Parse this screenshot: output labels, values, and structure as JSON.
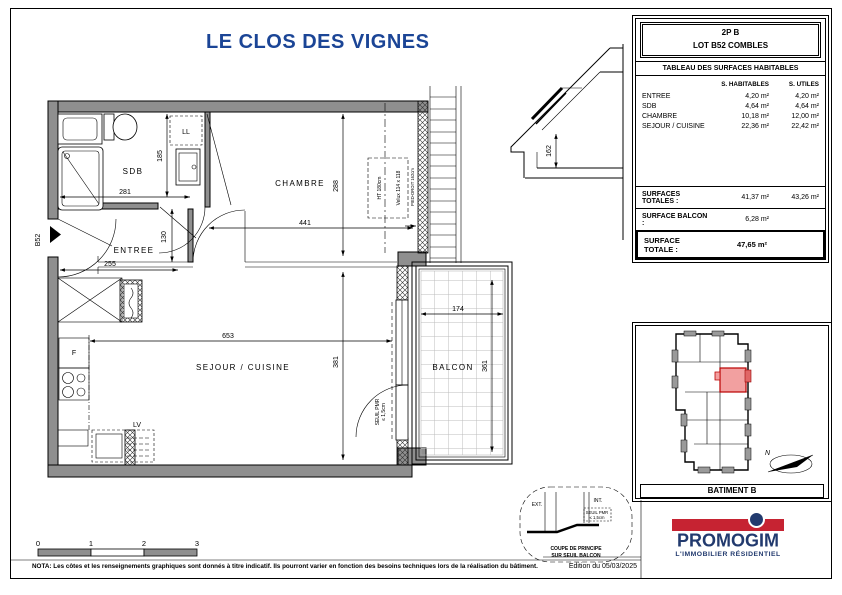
{
  "title": "LE CLOS DES VIGNES",
  "colors": {
    "title_blue": "#1b4596",
    "promogim_blue": "#223a6e",
    "promogim_red": "#c62332",
    "wall_gray": "#8f8f8f",
    "highlight_pink": "#f2a0a0",
    "highlight_red": "#bb0000"
  },
  "surface_table": {
    "unit": "2P B",
    "lot": "LOT B52 COMBLES",
    "table_title": "TABLEAU DES SURFACES HABITABLES",
    "col_habitables": "S. HABITABLES",
    "col_utiles": "S. UTILES",
    "rows": [
      {
        "name": "ENTREE",
        "habitable": "4,20 m²",
        "utile": "4,20 m²"
      },
      {
        "name": "SDB",
        "habitable": "4,64 m²",
        "utile": "4,64 m²"
      },
      {
        "name": "CHAMBRE",
        "habitable": "10,18 m²",
        "utile": "12,00 m²"
      },
      {
        "name": "SEJOUR / CUISINE",
        "habitable": "22,36 m²",
        "utile": "22,42 m²"
      }
    ],
    "totals": {
      "surfaces_totales_label": "SURFACES TOTALES :",
      "surfaces_totales_habitable": "41,37 m²",
      "surfaces_totales_utile": "43,26 m²",
      "surface_balcon_label": "SURFACE BALCON :",
      "surface_balcon_value": "6,28 m²",
      "surface_totale_label": "SURFACE TOTALE :",
      "surface_totale_value": "47,65 m²"
    }
  },
  "plan": {
    "rooms": {
      "sdb": "SDB",
      "ll": "LL",
      "chambre": "CHAMBRE",
      "entree": "ENTREE",
      "sejour": "SEJOUR / CUISINE",
      "balcon": "BALCON",
      "frigo": "F",
      "lv": "LV"
    },
    "unit_door_label": "B52",
    "dims": {
      "sdb_width": "281",
      "sdb_height": "185",
      "chambre_width": "441",
      "chambre_height": "288",
      "entree_width": "255",
      "entree_height": "130",
      "sejour_width": "653",
      "sejour_height": "381",
      "balcon_width": "174",
      "balcon_height": "361",
      "section_pied_droit": "162"
    },
    "velux": {
      "label": "Velux 114 x 118",
      "ht": "HT 180cm",
      "pied_droit": "PIED-DROIT 162cm"
    },
    "seuil": {
      "line1": "SEUIL PMR",
      "line2": "≤ 1,5cm"
    }
  },
  "coupe": {
    "ext": "EXT.",
    "int": "INT.",
    "seuil_line1": "SEUIL PMR",
    "seuil_line2": "≤ 1,5cm",
    "caption_line1": "COUPE DE PRINCIPE",
    "caption_line2": "SUR SEUIL BALCON"
  },
  "location": {
    "caption": "BATIMENT B",
    "north": "N"
  },
  "scale_bar": {
    "t0": "0",
    "t1": "1",
    "t2": "2",
    "t3": "3"
  },
  "footer": {
    "nota": "NOTA: Les côtes et les renseignements graphiques sont donnés à titre indicatif. Ils pourront varier en fonction des besoins techniques lors de la réalisation du bâtiment.",
    "edition": "Edition du 05/03/2025"
  },
  "logo": {
    "name": "PROMOGIM",
    "tagline": "L'IMMOBILIER RÉSIDENTIEL"
  }
}
